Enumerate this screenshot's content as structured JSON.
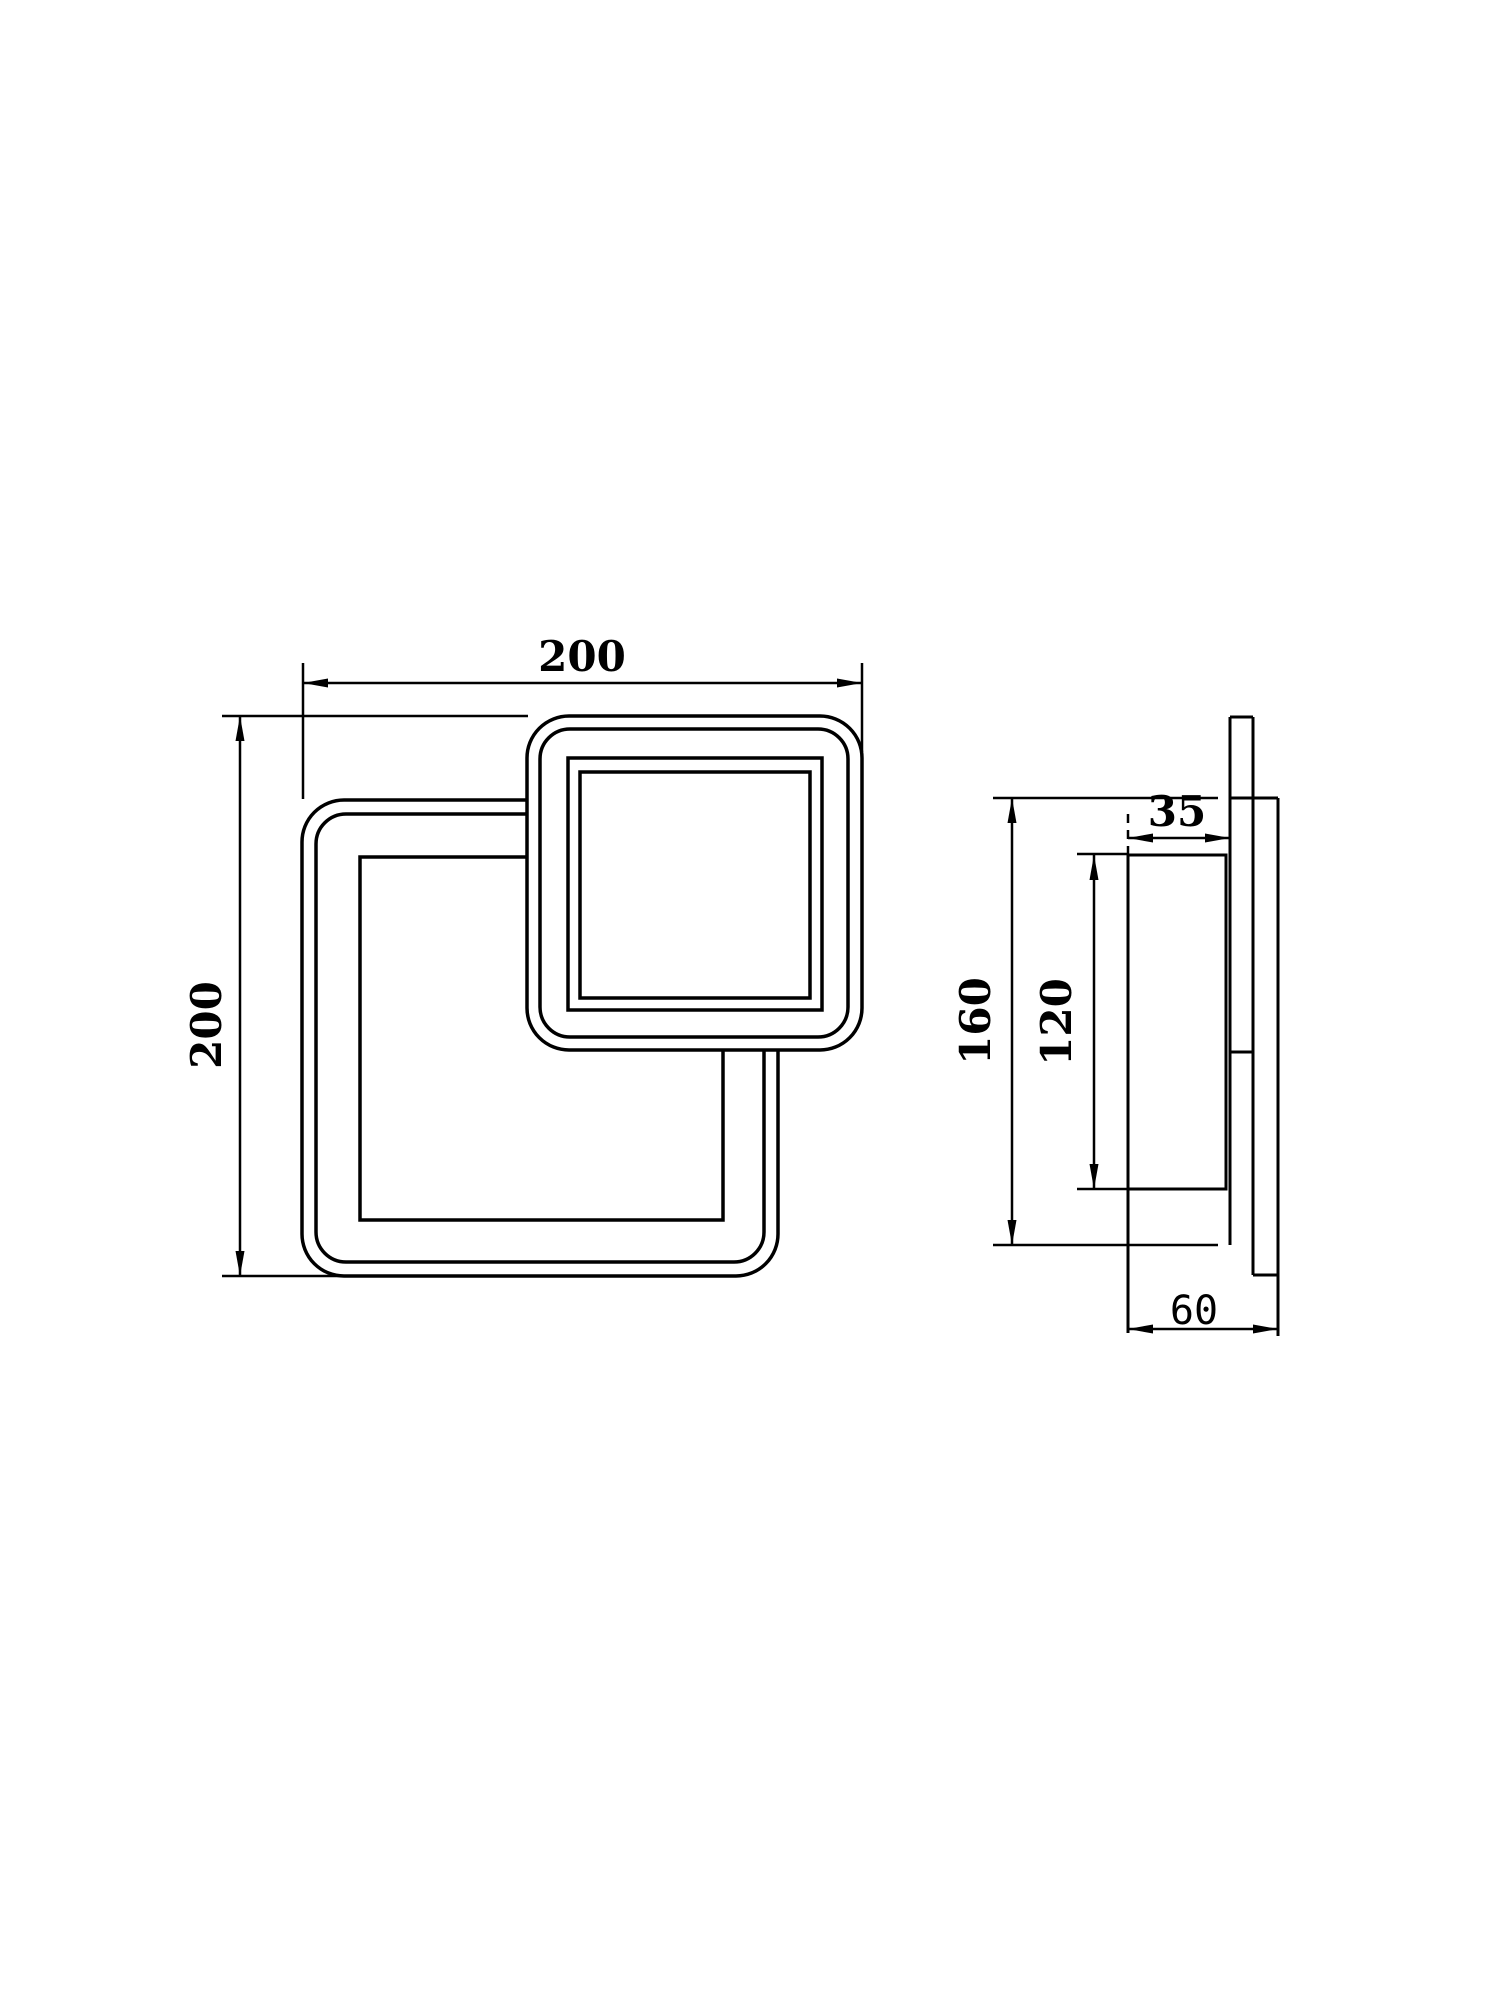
{
  "document": {
    "type": "technical-dimension-drawing",
    "views": {
      "front_view": {
        "name": "front view",
        "width_label": "200",
        "height_label": "200"
      },
      "side_view": {
        "name": "side profile view",
        "depth_label": "35",
        "height_label": "160",
        "inner_height_label": "120",
        "total_depth_label": "60"
      }
    },
    "colors": {
      "line": "#000000",
      "background": "#ffffff"
    }
  }
}
